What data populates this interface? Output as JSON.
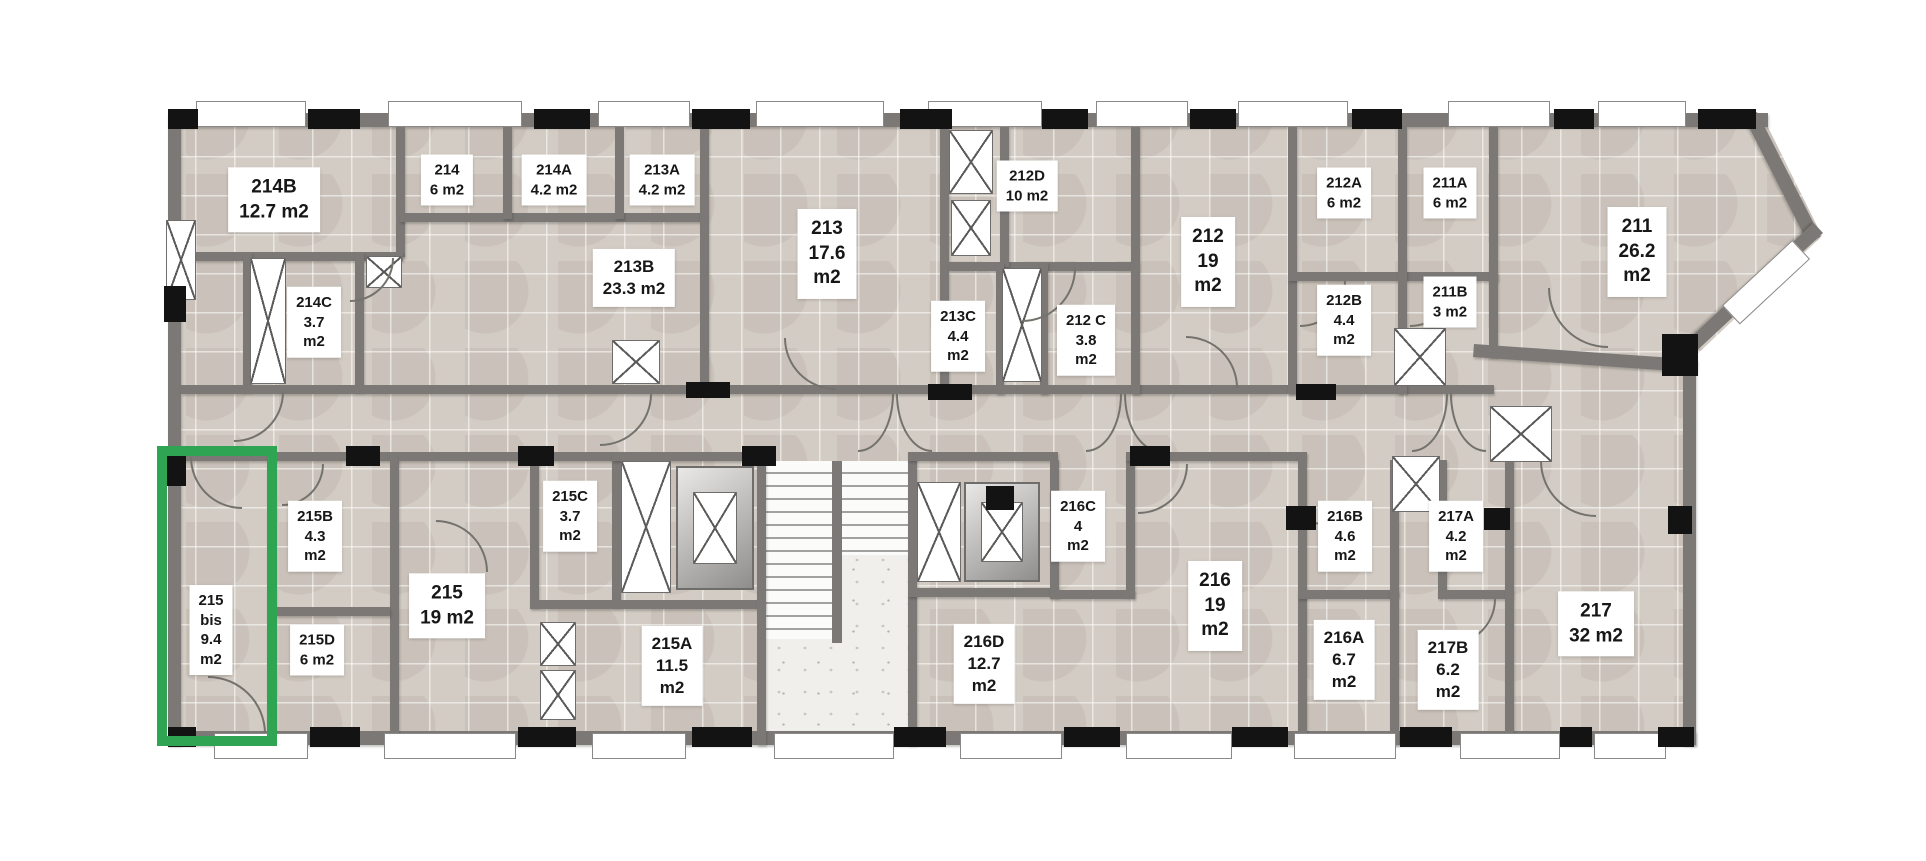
{
  "floorplan": {
    "area_unit": "m2",
    "highlight": {
      "room_id": "215 bis",
      "area": "9.4 m2",
      "color": "#2FA452"
    },
    "rooms": [
      {
        "id": "214B",
        "lines": [
          "214B",
          "12.7 m2"
        ],
        "cx": 274,
        "cy": 200,
        "fs": 19
      },
      {
        "id": "214",
        "lines": [
          "214",
          "6 m2"
        ],
        "cx": 447,
        "cy": 180,
        "fs": 15
      },
      {
        "id": "214A",
        "lines": [
          "214A",
          "4.2 m2"
        ],
        "cx": 554,
        "cy": 180,
        "fs": 15
      },
      {
        "id": "213A",
        "lines": [
          "213A",
          "4.2 m2"
        ],
        "cx": 662,
        "cy": 180,
        "fs": 15
      },
      {
        "id": "214C",
        "lines": [
          "214C",
          "3.7",
          "m2"
        ],
        "cx": 314,
        "cy": 322,
        "fs": 15
      },
      {
        "id": "213B",
        "lines": [
          "213B",
          "23.3 m2"
        ],
        "cx": 634,
        "cy": 278,
        "fs": 17
      },
      {
        "id": "213",
        "lines": [
          "213",
          "17.6",
          "m2"
        ],
        "cx": 827,
        "cy": 254,
        "fs": 19
      },
      {
        "id": "212D",
        "lines": [
          "212D",
          "10 m2"
        ],
        "cx": 1027,
        "cy": 186,
        "fs": 15
      },
      {
        "id": "213C",
        "lines": [
          "213C",
          "4.4",
          "m2"
        ],
        "cx": 958,
        "cy": 336,
        "fs": 15
      },
      {
        "id": "212C",
        "lines": [
          "212 C",
          "3.8",
          "m2"
        ],
        "cx": 1086,
        "cy": 340,
        "fs": 15
      },
      {
        "id": "212",
        "lines": [
          "212",
          "19",
          "m2"
        ],
        "cx": 1208,
        "cy": 262,
        "fs": 19
      },
      {
        "id": "212A",
        "lines": [
          "212A",
          "6 m2"
        ],
        "cx": 1344,
        "cy": 193,
        "fs": 15
      },
      {
        "id": "211A",
        "lines": [
          "211A",
          "6 m2"
        ],
        "cx": 1450,
        "cy": 193,
        "fs": 15
      },
      {
        "id": "212B",
        "lines": [
          "212B",
          "4.4",
          "m2"
        ],
        "cx": 1344,
        "cy": 320,
        "fs": 15
      },
      {
        "id": "211B",
        "lines": [
          "211B",
          "3 m2"
        ],
        "cx": 1450,
        "cy": 302,
        "fs": 15
      },
      {
        "id": "211",
        "lines": [
          "211",
          "26.2",
          "m2"
        ],
        "cx": 1637,
        "cy": 252,
        "fs": 19
      },
      {
        "id": "215 bis",
        "lines": [
          "215",
          "bis",
          "9.4",
          "m2"
        ],
        "cx": 211,
        "cy": 630,
        "fs": 15,
        "highlight": true
      },
      {
        "id": "215B",
        "lines": [
          "215B",
          "4.3",
          "m2"
        ],
        "cx": 315,
        "cy": 536,
        "fs": 15
      },
      {
        "id": "215D",
        "lines": [
          "215D",
          "6 m2"
        ],
        "cx": 317,
        "cy": 650,
        "fs": 15
      },
      {
        "id": "215",
        "lines": [
          "215",
          "19 m2"
        ],
        "cx": 447,
        "cy": 606,
        "fs": 19
      },
      {
        "id": "215C",
        "lines": [
          "215C",
          "3.7",
          "m2"
        ],
        "cx": 570,
        "cy": 516,
        "fs": 15
      },
      {
        "id": "215A",
        "lines": [
          "215A",
          "11.5",
          "m2"
        ],
        "cx": 672,
        "cy": 666,
        "fs": 17
      },
      {
        "id": "216D",
        "lines": [
          "216D",
          "12.7",
          "m2"
        ],
        "cx": 984,
        "cy": 664,
        "fs": 17
      },
      {
        "id": "216C",
        "lines": [
          "216C",
          "4",
          "m2"
        ],
        "cx": 1078,
        "cy": 526,
        "fs": 15
      },
      {
        "id": "216",
        "lines": [
          "216",
          "19",
          "m2"
        ],
        "cx": 1215,
        "cy": 606,
        "fs": 19
      },
      {
        "id": "216B",
        "lines": [
          "216B",
          "4.6",
          "m2"
        ],
        "cx": 1345,
        "cy": 536,
        "fs": 15
      },
      {
        "id": "216A",
        "lines": [
          "216A",
          "6.7",
          "m2"
        ],
        "cx": 1344,
        "cy": 660,
        "fs": 17
      },
      {
        "id": "217A",
        "lines": [
          "217A",
          "4.2",
          "m2"
        ],
        "cx": 1456,
        "cy": 536,
        "fs": 15
      },
      {
        "id": "217B",
        "lines": [
          "217B",
          "6.2",
          "m2"
        ],
        "cx": 1448,
        "cy": 670,
        "fs": 17
      },
      {
        "id": "217",
        "lines": [
          "217",
          "32 m2"
        ],
        "cx": 1596,
        "cy": 624,
        "fs": 19
      }
    ]
  }
}
